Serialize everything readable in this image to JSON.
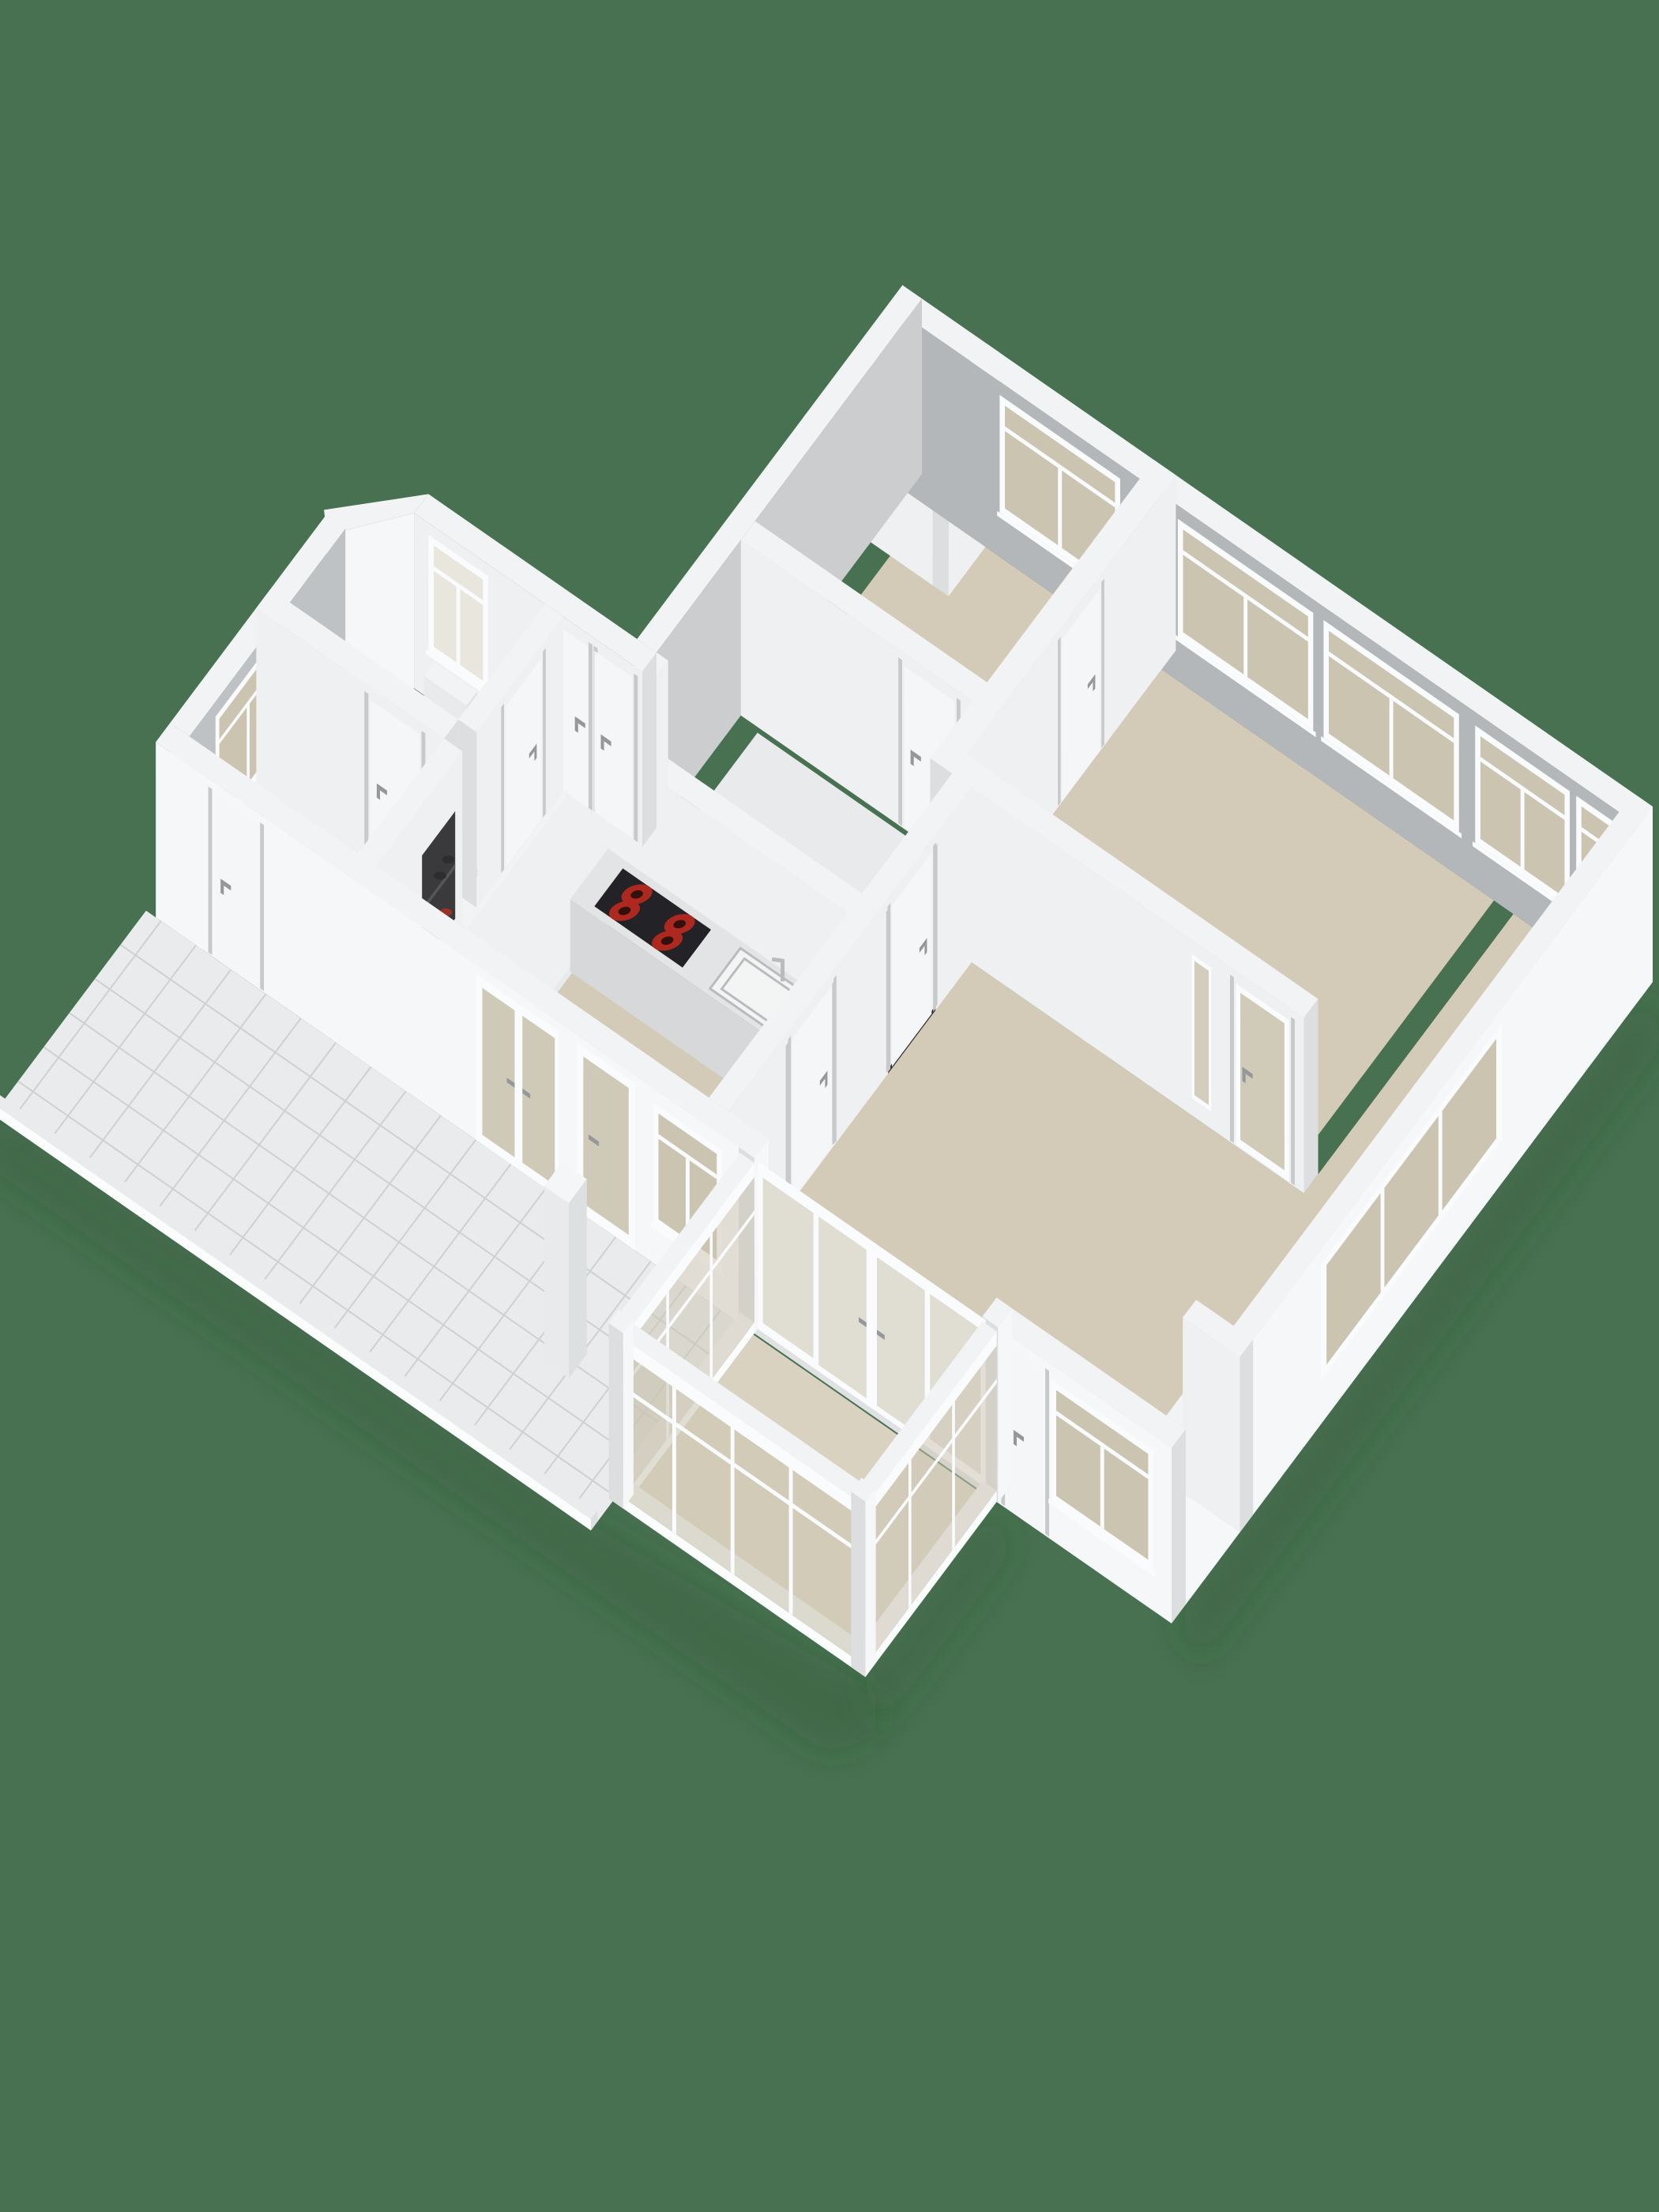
{
  "scene": {
    "type": "3d-isometric-floorplan-render",
    "background": "#477150"
  },
  "colors": {
    "bg": "#477150",
    "shadow": "#21402e",
    "wallTop": "#f2f3f4",
    "extFace": "#f6f7f8",
    "endFace": "#dcdee0",
    "intGray": "#b4b7b9",
    "intGrayLight": "#cbcdcf",
    "intWhite": "#eef0f1",
    "doorWhite": "#f5f6f7",
    "doorJamb": "#c7c9cb",
    "handle": "#95989b",
    "floorBeige": "#d3cbb7",
    "floorBeigeLight": "#d9d2c1",
    "floorGray": "#d3d4d6",
    "hallFloor": "#e8eaeb",
    "tile": "#e9ebec",
    "tileLine": "#cdd1d2",
    "slabEdge": "#fbfcfc",
    "glass": "#cbc4b1",
    "glassFrosted": "#e8e6dd",
    "frame": "#fafbfc",
    "counterTop": "#e3e4e6",
    "counterFace": "#d7d8da",
    "counterEnd": "#cdcfd1",
    "stoveTop": "#232327",
    "burner": "#ad291f",
    "burnerDark": "#33100c",
    "sinkFill": "#f3f4f4",
    "sinkEdge": "#b9bcbe",
    "nicheDark": "#3a3a3d",
    "shoeRed": "#9c3129",
    "shoeDark": "#2d2d30"
  },
  "objects": [
    {
      "name": "cooktop-with-four-red-burners"
    },
    {
      "name": "kitchen-sink-with-faucet"
    },
    {
      "name": "kitchen-counter"
    },
    {
      "name": "shoe-niche-with-shoes"
    },
    {
      "name": "radiator-under-frosted-window"
    },
    {
      "name": "closet-double-doors"
    },
    {
      "name": "french-doors-to-sunroom"
    },
    {
      "name": "glazed-front-door"
    },
    {
      "name": "terrace-pillar"
    },
    {
      "name": "tiled-outdoor-gallery"
    },
    {
      "name": "sunroom-glazed-walls"
    },
    {
      "name": "bedroom-windows"
    },
    {
      "name": "living-room-windows"
    },
    {
      "name": "frosted-bathroom-window"
    }
  ]
}
